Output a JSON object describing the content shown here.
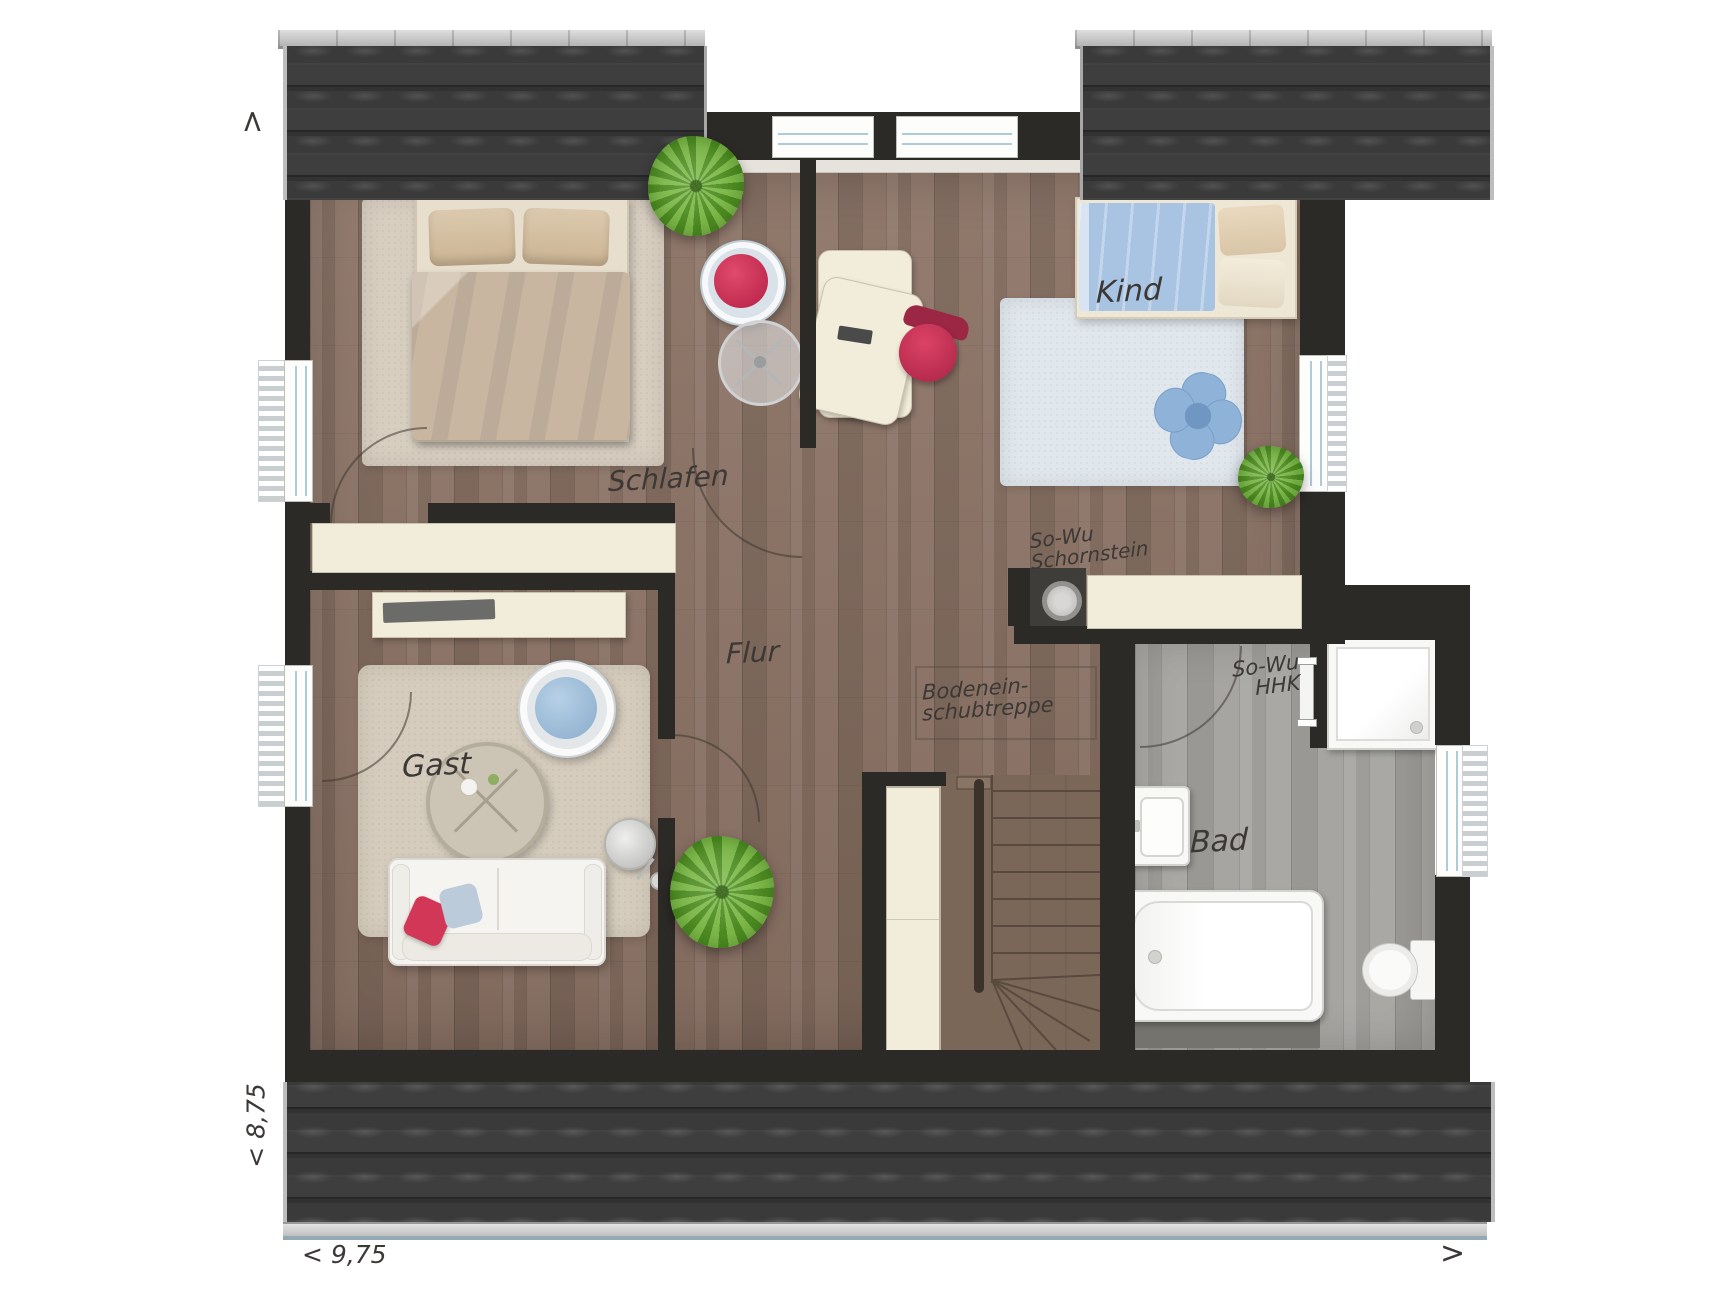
{
  "rooms": {
    "schlafen": "Schlafen",
    "kind": "Kind",
    "flur": "Flur",
    "gast": "Gast",
    "bad": "Bad"
  },
  "annotations": {
    "schornstein_line1": "So-Wu",
    "schornstein_line2": "Schornstein",
    "hhk_line1": "So-Wu",
    "hhk_line2": "HHK",
    "bodentreppe_line1": "Bodenein-",
    "bodentreppe_line2": "schubtreppe"
  },
  "dimensions": {
    "depth": "< 8,75",
    "width": "< 9,75",
    "arrow_top_left": ">",
    "arrow_bottom_right": ">"
  },
  "colors": {
    "roof_tile": "#3a3a3a",
    "roof_ridge": "#c9c9c9",
    "gutter_accent": "#93a9b4",
    "wall": "#2c2a27",
    "wood_floor": "#8a7163",
    "bath_floor": "#a6a5a1",
    "stair_wood": "#7b6757",
    "cream_furniture": "#f2ecdb",
    "rug_beige": "#d7cec0",
    "bed_duvet_beige": "#c8b6a1",
    "kids_duvet_blue": "#a9c4e2",
    "kids_rug_blue": "#e0e7ed",
    "accent_red": "#d23758",
    "cushion_blue": "#bccbd9",
    "plant_green": "#79b645",
    "fixture_white": "#f8f8f6"
  }
}
